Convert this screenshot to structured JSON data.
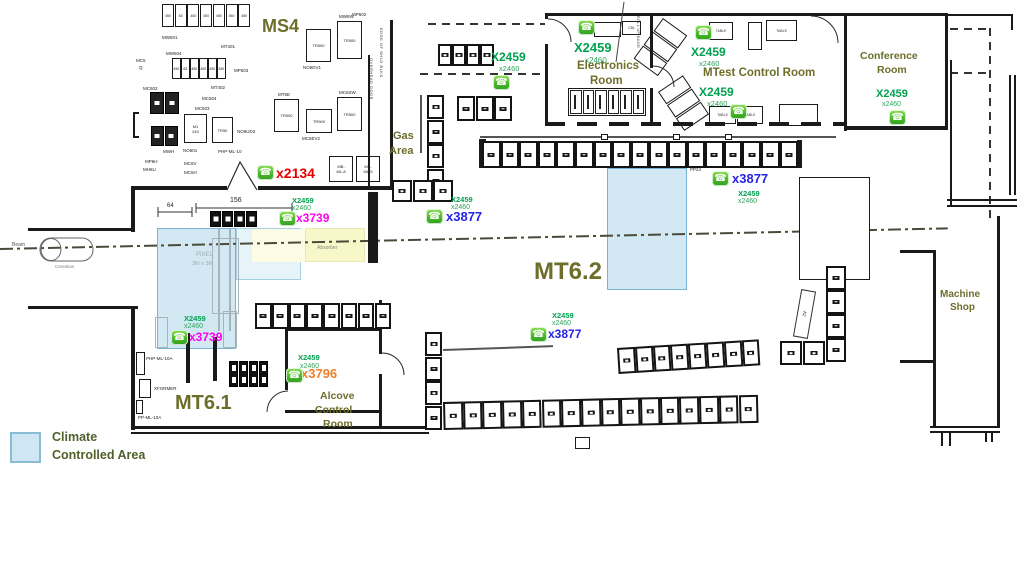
{
  "colors": {
    "area_label_olive": "#6c6e2a",
    "extension_green": "#00a14f",
    "sub_extension_green": "#2ea55d",
    "ext_red": "#e60000",
    "ext_magenta": "#ff00f0",
    "ext_orange": "#ee7d2a",
    "ext_blue": "#2323e8",
    "climate_blue_fill": "#cfe6f4",
    "climate_blue_border": "#79b4d2",
    "absorber_yellow": "#f7f7c9"
  },
  "icons": {
    "phone": "☎"
  },
  "legend": {
    "line1": "Climate",
    "line2": "Controlled Area"
  },
  "areas": {
    "ms4": "MS4",
    "mt61": "MT6.1",
    "mt62": "MT6.2",
    "gas1": "Gas",
    "gas2": "Area",
    "electronics1": "Electronics",
    "electronics2": "Room",
    "mtest": "MTest Control Room",
    "conference1": "Conference",
    "conference2": "Room",
    "machine1": "Machine",
    "machine2": "Shop",
    "alcove1": "Alcove",
    "alcove2": "Control",
    "alcove3": "Room",
    "absorber": "Absorber",
    "beam": "Beam",
    "cerenkov": "Cerenkov",
    "pixel1": "PIXEL",
    "pixel2": "3M x 3M"
  },
  "phones": [
    {
      "ext": "x2134",
      "color": "#e60000"
    },
    {
      "main": "X2459",
      "sub": "x2460",
      "ext": "x3739",
      "color": "#ff00f0"
    },
    {
      "main": "X2459",
      "sub": "x2460",
      "ext": "x3739",
      "color": "#ff00f0"
    },
    {
      "main": "X2459",
      "sub": "x2460",
      "ext": "x3796",
      "color": "#ee7d2a"
    },
    {
      "main": "X2459",
      "sub": "x2460",
      "ext": "x3877",
      "color": "#2323e8"
    },
    {
      "main": "X2459",
      "sub": "x2460",
      "ext": "x3877",
      "color": "#2323e8"
    },
    {
      "main": "X2459",
      "sub": "x2460",
      "ext": "x3877",
      "color": "#2323e8"
    },
    {
      "main": "X2459",
      "sub": "x2460"
    },
    {
      "main": "X2459",
      "sub": "x2460"
    },
    {
      "main": "X2459",
      "sub": "x2460"
    },
    {
      "main": "X2459",
      "sub": "x2460"
    },
    {
      "main": "X2459",
      "sub": "x2460"
    }
  ],
  "dimensions": {
    "width_64": "64",
    "width_156": "156"
  },
  "walls_text": {
    "overhead_door": "OVERHEAD DOOR",
    "edge_shld": "EDGE OF SHLD BLKS",
    "rollup": "ROLL UP DOOR"
  },
  "misc": {
    "table": "TABLE",
    "cbl": "CBL",
    "pp24": "PP24",
    "a2": "A2"
  },
  "equipment": {
    "ms4_row1": [
      "450",
      "63",
      "450",
      "450",
      "450",
      "450",
      "450"
    ],
    "ms4_row2": [
      "450",
      "63",
      "450",
      "450",
      "450",
      "450"
    ],
    "tr500": "TR500",
    "labels": {
      "mp502": "MP502",
      "mw501": "MW501",
      "mt401": "MT401",
      "mw504": "MW504",
      "mc5a": "MC5",
      "mc5b": "Q",
      "mp503": "MP503",
      "mt402": "MT402",
      "mc504": "MC504",
      "mc503": "MC503",
      "mc502": "MC502",
      "m1a": "M1",
      "m1b": "240",
      "tr50": "TR50",
      "no6ud2": "NO6UD2",
      "mwh": "MWH",
      "no601": "NO601",
      "mp6h": "MP6H",
      "mh6u": "MH6U",
      "mc6v": "MC6V",
      "mc6h": "MC6H",
      "php_ml_10": "PHP-ML-10",
      "mw6w": "MW6W",
      "no6dv1": "NO6DV1",
      "mt5e": "MT5E",
      "mc6ev2": "MC6EV2",
      "mc6sw": "MC6SW",
      "mbml8a": "MB-",
      "mbml8b": "ML-8",
      "mbml5a": "MB-",
      "mbml5b": "ML-5",
      "php_ml_10a": "PHP-ML-10A",
      "xformer": "XFORMER",
      "pp_ml_10a": "PP-ML-10A"
    }
  }
}
